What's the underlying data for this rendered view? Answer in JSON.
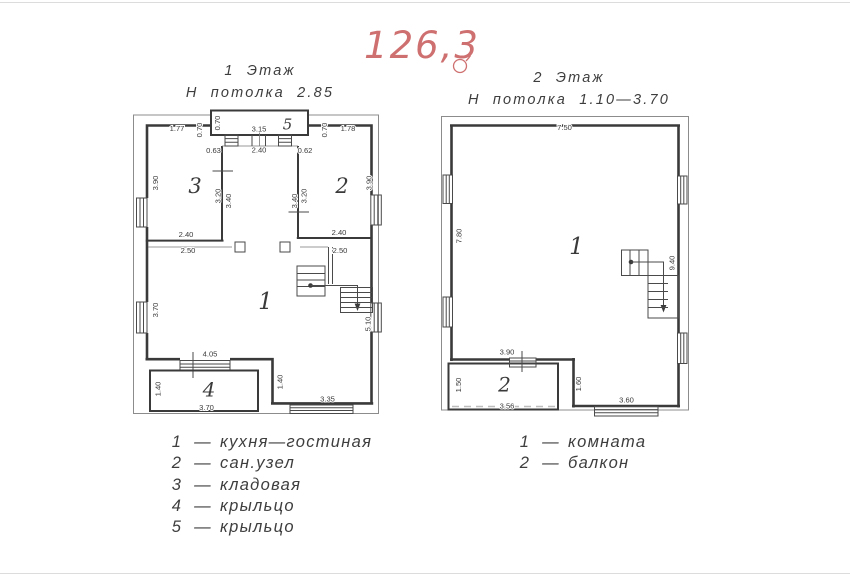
{
  "page": {
    "area_label": "126,3",
    "legend_dash": "—",
    "accent_color": "#cf7070",
    "ink_color": "#3a3a3a"
  },
  "floor1": {
    "title": "1 Этаж",
    "subtitle": "Н потолка 2.85",
    "room_labels": {
      "living": "1",
      "bath": "2",
      "storage": "3",
      "porch": "4",
      "stoop": "5"
    },
    "dims": {
      "top_left": "1.77",
      "porch5_side_left": "0.70",
      "porch5_inner": "0.70",
      "porch5_width": "3.15",
      "porch5_side_right": "0.70",
      "top_right": "1.78",
      "entry_left": "0.63",
      "entry_width": "2.40",
      "entry_right": "0.62",
      "storage_outer_h": "3.90",
      "storage_wall_inner": "3.20",
      "storage_wall_outer": "3.40",
      "bath_wall_outer": "3.40",
      "bath_wall_inner": "3.20",
      "bath_outer_h": "3.90",
      "storage_w_inner": "2.40",
      "storage_w_outer": "2.50",
      "bath_w_inner": "2.40",
      "bath_w_outer": "2.50",
      "left_lower_h": "3.70",
      "stair_side": "5.10",
      "entrance_w": "4.05",
      "porch_h": "1.40",
      "porch_w": "3.70",
      "ledge_h": "1.40",
      "steps_w": "3.35"
    },
    "legend": [
      {
        "num": "1",
        "label": "кухня—гостиная"
      },
      {
        "num": "2",
        "label": "сан.узел"
      },
      {
        "num": "3",
        "label": "кладовая"
      },
      {
        "num": "4",
        "label": "крыльцо"
      },
      {
        "num": "5",
        "label": "крыльцо"
      }
    ]
  },
  "floor2": {
    "title": "2 Этаж",
    "subtitle": "Н потолка 1.10—3.70",
    "room_labels": {
      "room": "1",
      "balcony": "2"
    },
    "dims": {
      "top_w": "7.50",
      "left_h": "7.80",
      "stair_h": "9.40",
      "balcony_door_w": "3.90",
      "balcony_h": "1.50",
      "balcony_w": "3.56",
      "ledge_h": "1.60",
      "steps_w": "3.60"
    },
    "legend": [
      {
        "num": "1",
        "label": "комната"
      },
      {
        "num": "2",
        "label": "балкон"
      }
    ]
  }
}
